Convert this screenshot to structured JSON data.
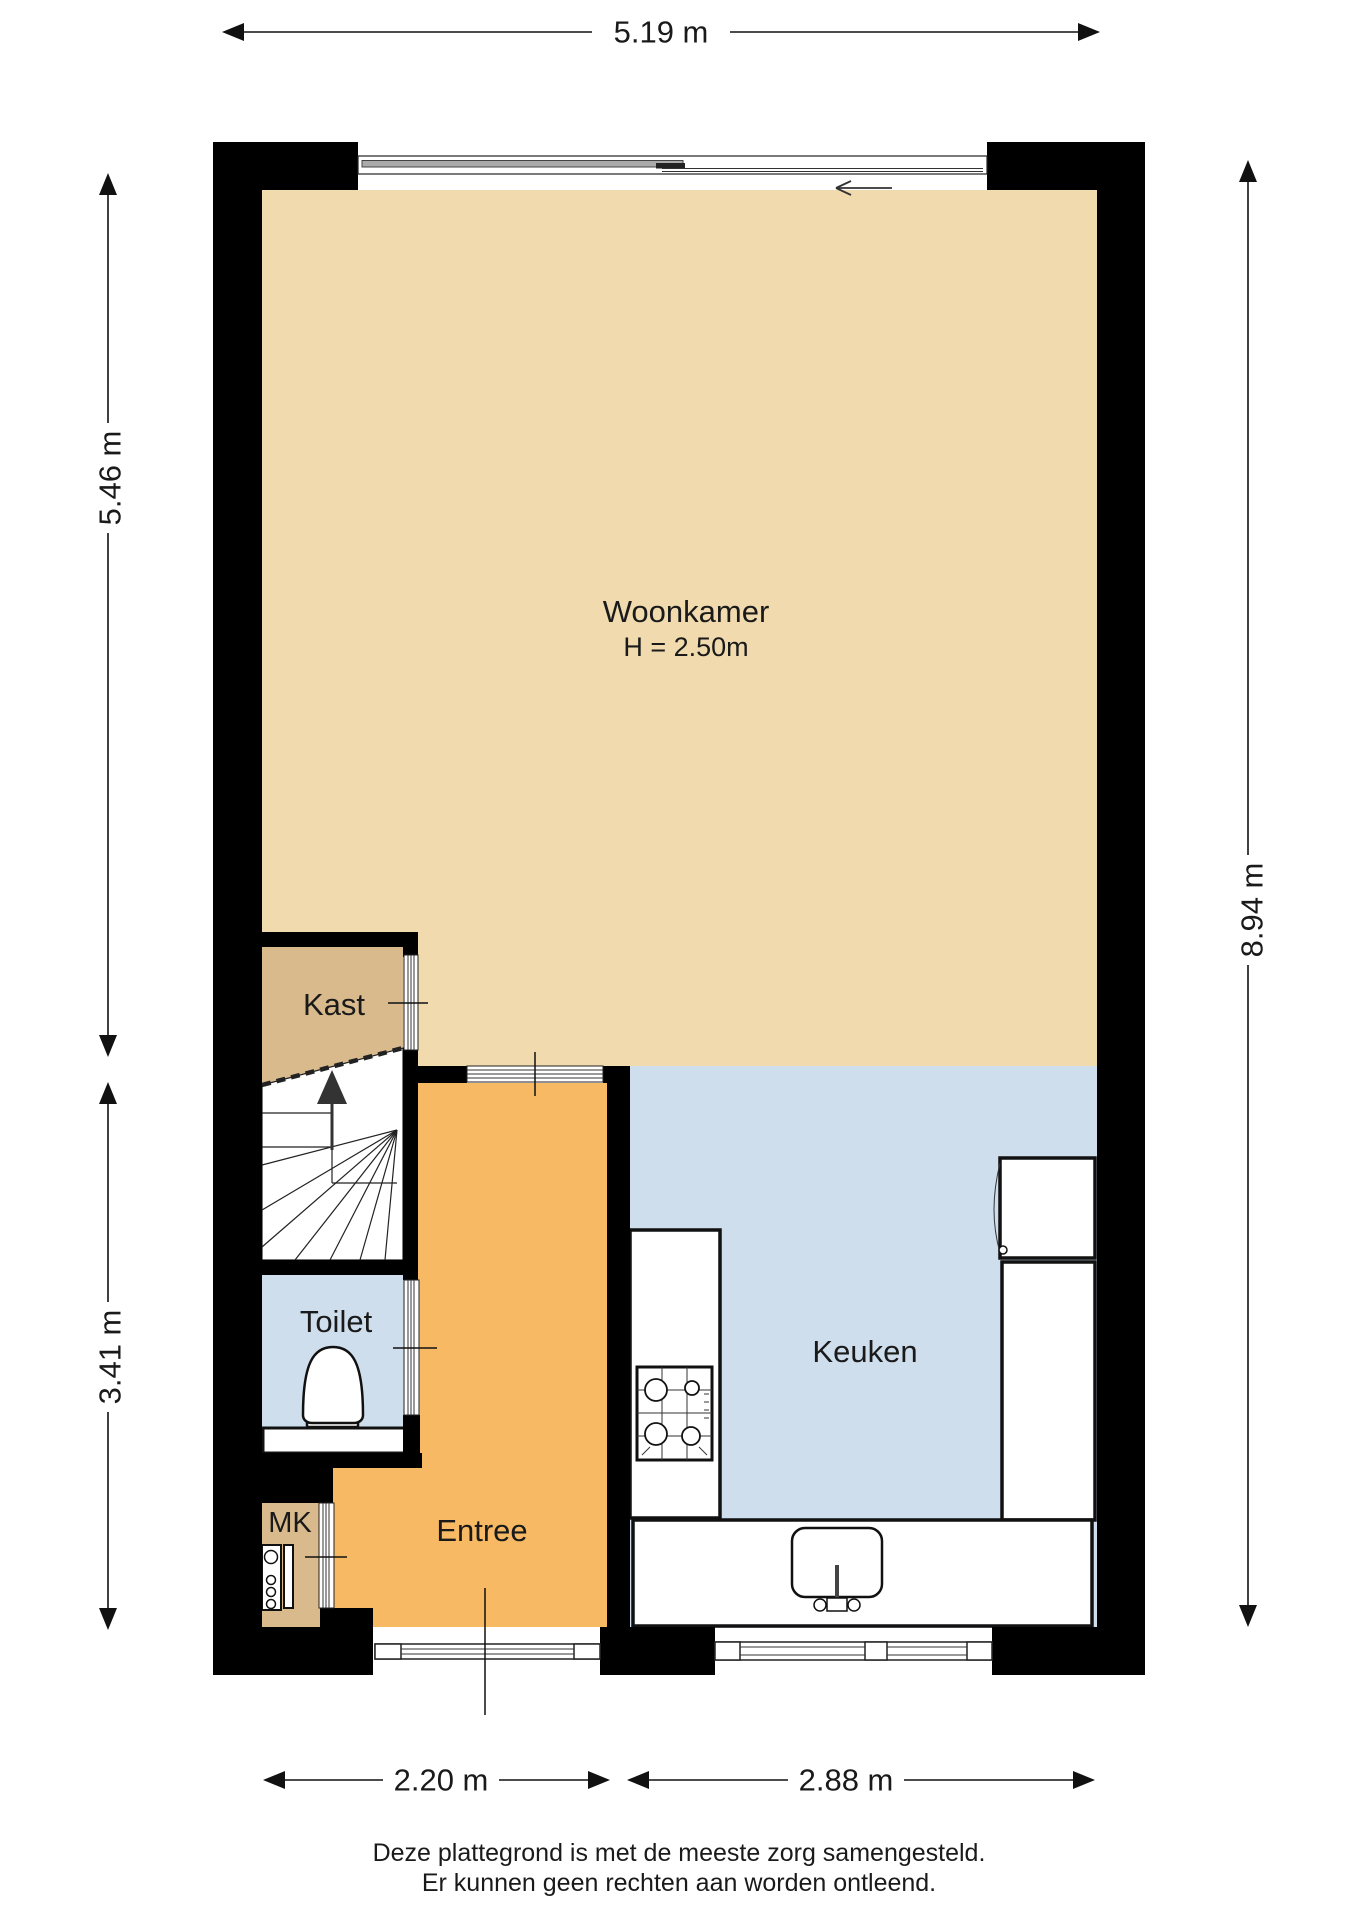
{
  "rooms": {
    "woonkamer": {
      "label": "Woonkamer",
      "height_note": "H = 2.50m"
    },
    "kast": {
      "label": "Kast"
    },
    "toilet": {
      "label": "Toilet"
    },
    "keuken": {
      "label": "Keuken"
    },
    "entree": {
      "label": "Entree"
    },
    "mk": {
      "label": "MK"
    }
  },
  "dimensions": {
    "top_width": "5.19 m",
    "left_upper": "5.46 m",
    "left_lower": "3.41 m",
    "right_height": "8.94 m",
    "bottom_left": "2.20 m",
    "bottom_right": "2.88 m"
  },
  "footer": {
    "line1": "Deze plattegrond is met de meeste zorg samengesteld.",
    "line2": "Er kunnen geen rechten aan worden ontleend."
  },
  "colors": {
    "woonkamer_floor": "#F0DAAE",
    "kast_floor": "#D9BA8C",
    "wet_floor": "#CFDEED",
    "entree_floor": "#F7B964",
    "wall": "#000000",
    "text": "#1a1a1a"
  }
}
